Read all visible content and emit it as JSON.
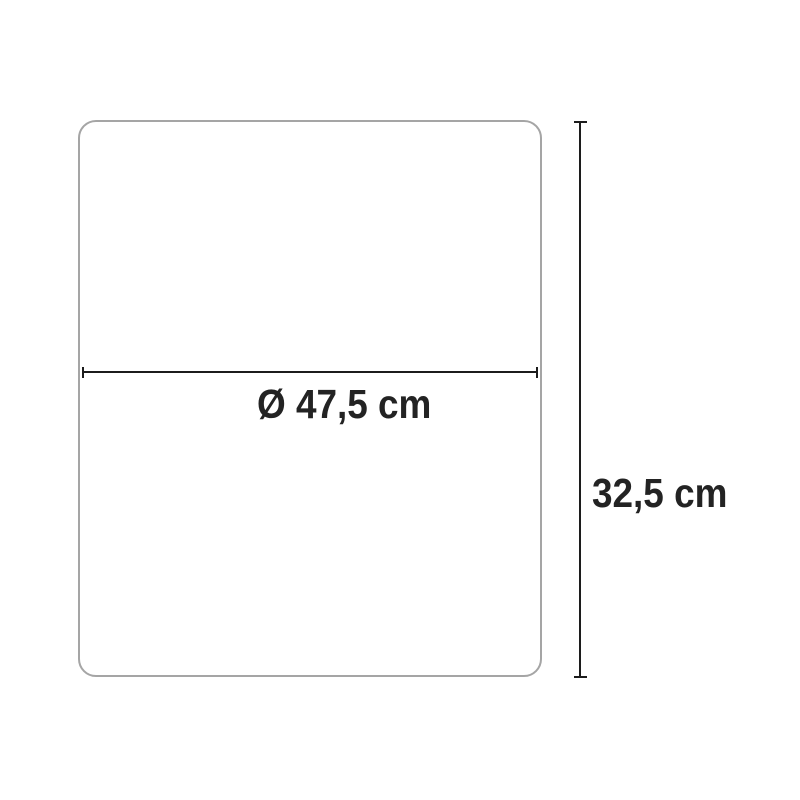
{
  "diagram": {
    "type": "product-dimension-diagram",
    "shape": "rounded-rectangle-outline",
    "width_label": "Ø 47,5 cm",
    "height_label": "32,5 cm",
    "dimensions": [
      {
        "axis": "horizontal",
        "value": "47,5",
        "unit": "cm",
        "is_diameter": true,
        "label": "Ø 47,5 cm"
      },
      {
        "axis": "vertical",
        "value": "32,5",
        "unit": "cm",
        "is_diameter": false,
        "label": "32,5 cm"
      }
    ],
    "colors": {
      "background": "#ffffff",
      "shape_border": "#a5a5a5",
      "dimension_line": "#1c1c1c",
      "label_text": "#232323"
    }
  }
}
